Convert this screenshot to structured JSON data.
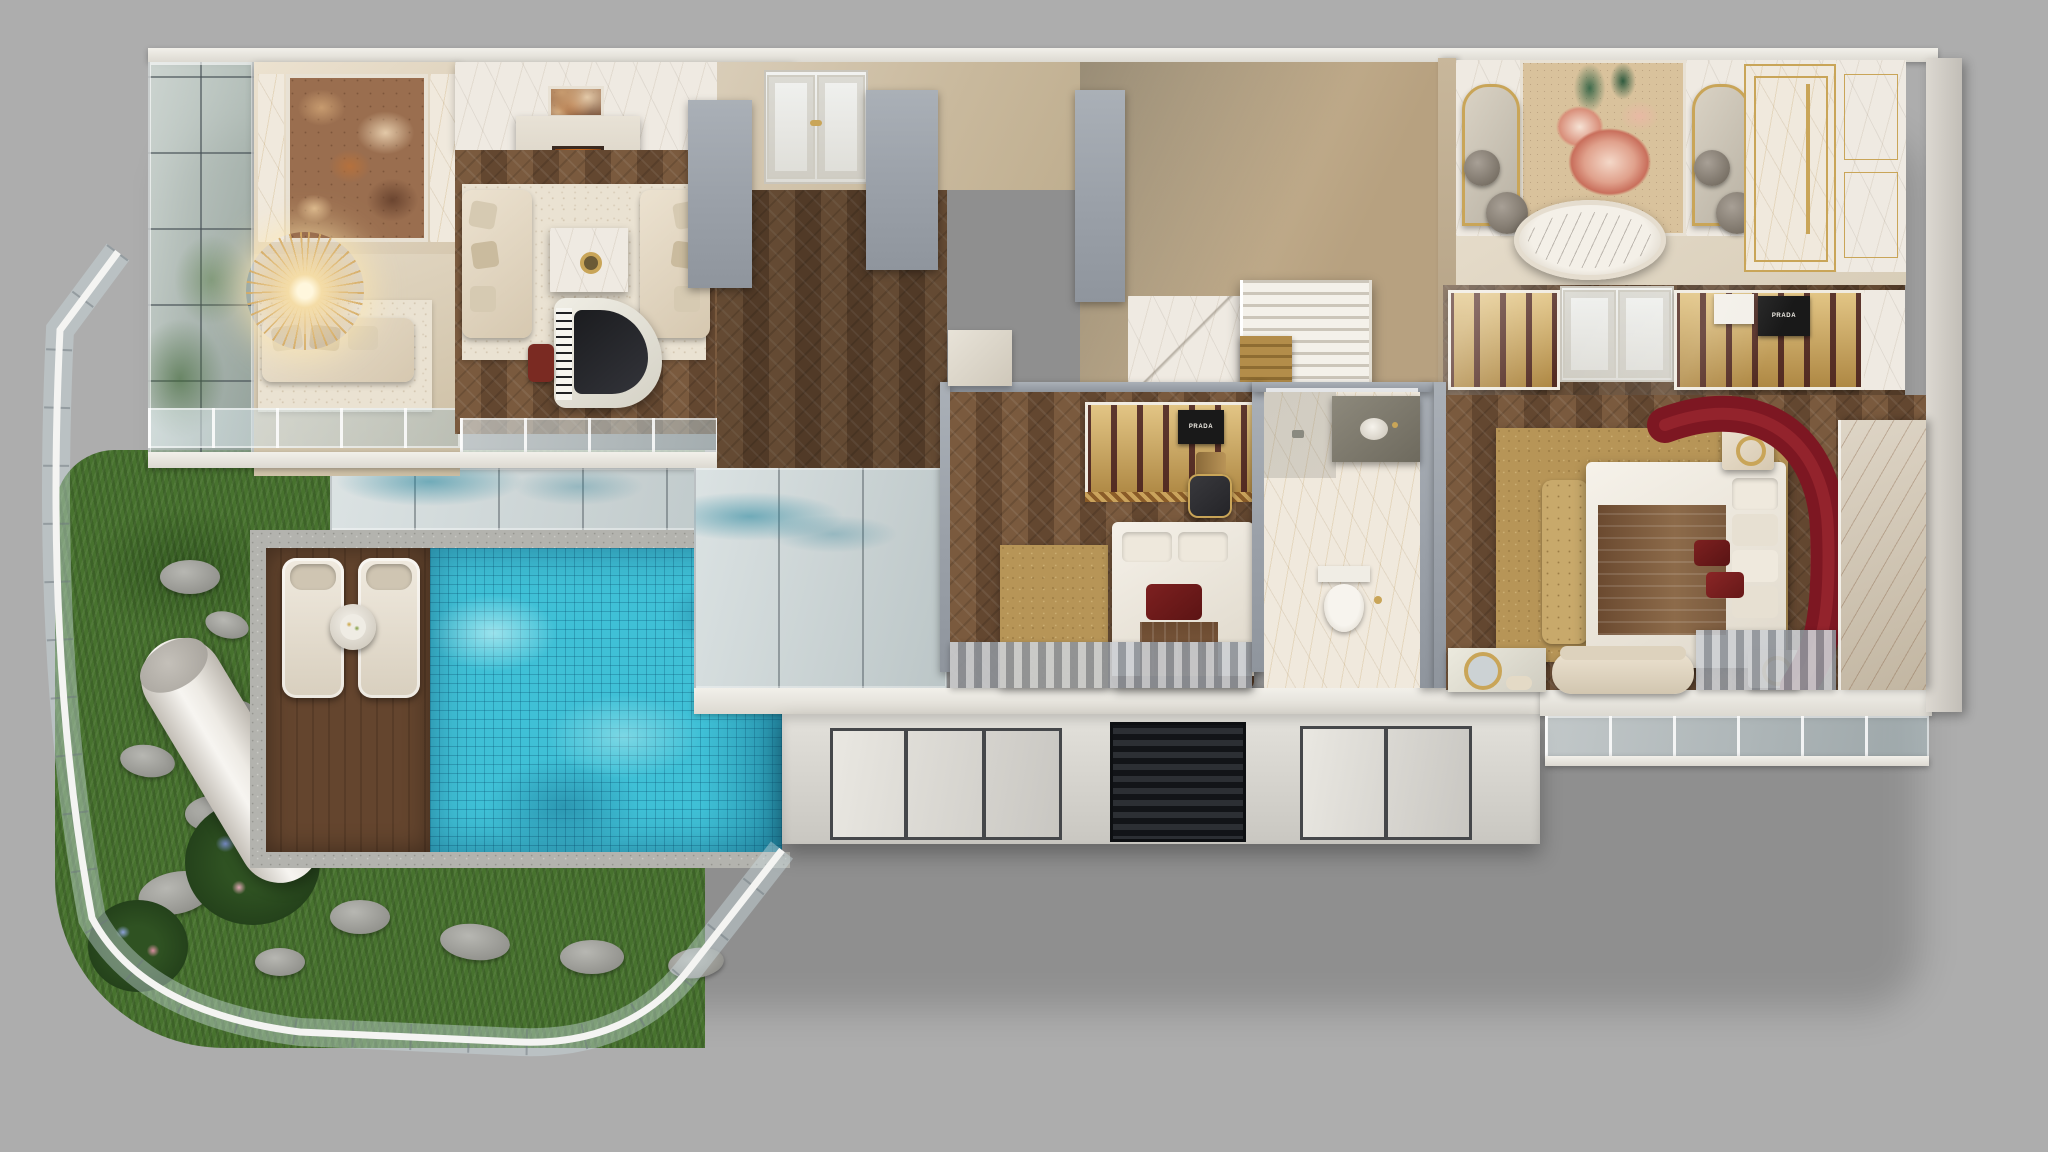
{
  "scene": {
    "title": "Luxury duplex penthouse — 3D cutaway dollhouse floor plan render",
    "view": "isometric top-down section cut, two levels",
    "background_color": "#adadad"
  },
  "palette": {
    "background": "#adadad",
    "herringbone_wood": "#6e4f36",
    "white_marble": "#efeae2",
    "beige_wall": "#d9cdb8",
    "cut_wall_gray": "#9aa0a8",
    "pool_turquoise": "#3fc0d6",
    "grass_green": "#47722e",
    "deck_wood": "#5d3f2b",
    "accent_gold": "#c9a558",
    "sofa_cream": "#e3d8c6",
    "sofa_red": "#7d1722",
    "rug_gold": "#b79557",
    "feature_marble_brown": "#9a6e4f"
  },
  "rooms": [
    {
      "id": "double-height-lounge",
      "label": "Double-height lounge: brown marble feature wall, crystal chandelier, cream sofa, glass curtain wall"
    },
    {
      "id": "living-room",
      "label": "Formal living room: fireplace, facing cream sofas, marble coffee table, white grand piano"
    },
    {
      "id": "entry-foyer",
      "label": "Entry foyer with white double doors"
    },
    {
      "id": "stair-hall",
      "label": "Stair hall with white marble staircase and gold lower steps"
    },
    {
      "id": "master-bathroom",
      "label": "Master bathroom: floral mosaic mural, marble freestanding tub, twin gold arched mirrors, gold shower"
    },
    {
      "id": "walk-in-wardrobe",
      "label": "Walk-in wardrobe with gold-lit cabinets and designer bags"
    },
    {
      "id": "master-bedroom",
      "label": "Master bedroom: gold shag rug, tufted bench, curved red sofa, marble feature wall"
    },
    {
      "id": "guest-bedroom",
      "label": "Guest bedroom with gold wardrobe and red accent pillows"
    },
    {
      "id": "ensuite-bathroom",
      "label": "En-suite bathroom: marble floor, stone vanity, toilet, walk-in shower"
    },
    {
      "id": "garden-terrace",
      "label": "Lower garden terrace: lawn, stepping stones, flowers, white column, curved glass balustrade"
    },
    {
      "id": "pool-deck",
      "label": "Timber pool deck with two loungers and side table"
    },
    {
      "id": "swimming-pool",
      "label": "Turquoise mosaic-tiled swimming pool"
    },
    {
      "id": "lower-lounge",
      "label": "Lower-level lounge seen through glass"
    },
    {
      "id": "facade",
      "label": "Lower facade with framed windows and dark louvre panel"
    }
  ],
  "labels": {
    "bag_brand": "PRADA"
  }
}
